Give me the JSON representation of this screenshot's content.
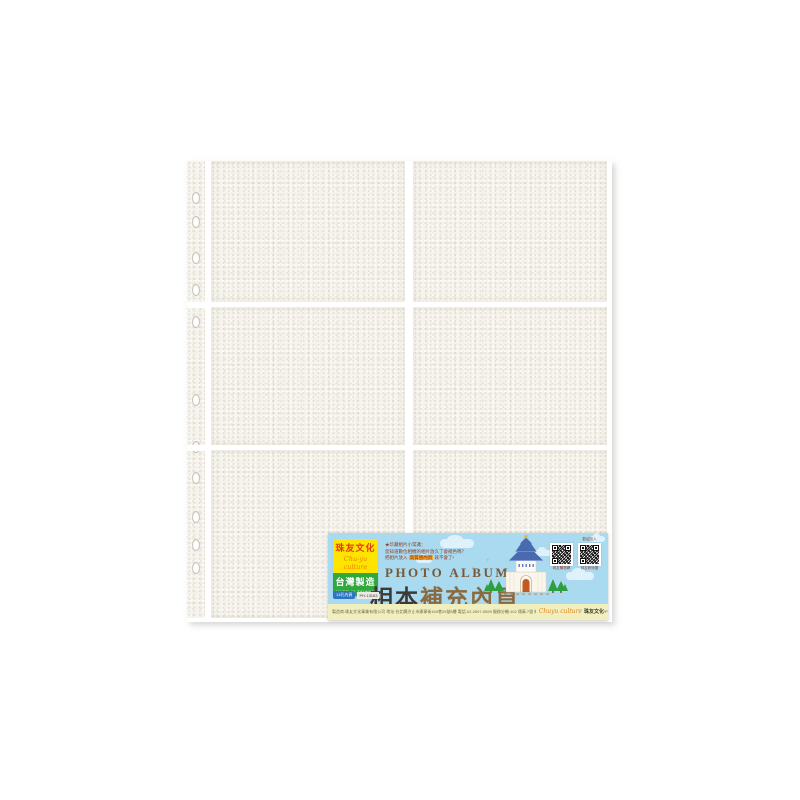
{
  "banner": {
    "brand": {
      "name_cn": "珠友文化",
      "name_script": "Chu-yu culture",
      "made_in_cn": "台灣製造",
      "made_in_en": "MADE IN TAIWAN"
    },
    "tips": {
      "line1": "★珍藏相片小常識：",
      "line2": "您知道數位相機的相片放久了會褪色嗎？",
      "line3_prefix": "把相片放入 ",
      "line3_highlight": "高質感內頁",
      "line3_suffix": " 就不會了!"
    },
    "title_en": "PHOTO  ALBUM",
    "title_cn_part1": "相本",
    "title_cn_part2": "補充內頁",
    "spec_badge": "13孔內頁",
    "item_code": "PH-13163",
    "qr": {
      "caption_left": "珠友購物網",
      "caption_right_top": "歡迎加入",
      "caption_right": "珠友粉絲團"
    },
    "footer": {
      "info": "製造商:珠友文化事業有限公司 地址:台北縣汐止市康寧街169巷25號5樓 電話:02-2697-5559 服務分機:102 傳真:7號 網址:http://www.chuyculture.com 材質:PP 台灣製造",
      "brand_script": "Chuyu culture ",
      "brand_cn": "珠友文化"
    }
  },
  "colors": {
    "sky_blue": "#a9daef",
    "footer_yellow": "#f2efbe",
    "brand_yellow": "#ffe400",
    "brand_red": "#e8380d",
    "brand_green": "#2fa83c",
    "title_dark": "#3d3935",
    "title_brown": "#8a6a3f",
    "sheet_cream": "#f6f3ec",
    "roof_blue": "#4a6ab0",
    "tree_green": "#2f9e41"
  }
}
